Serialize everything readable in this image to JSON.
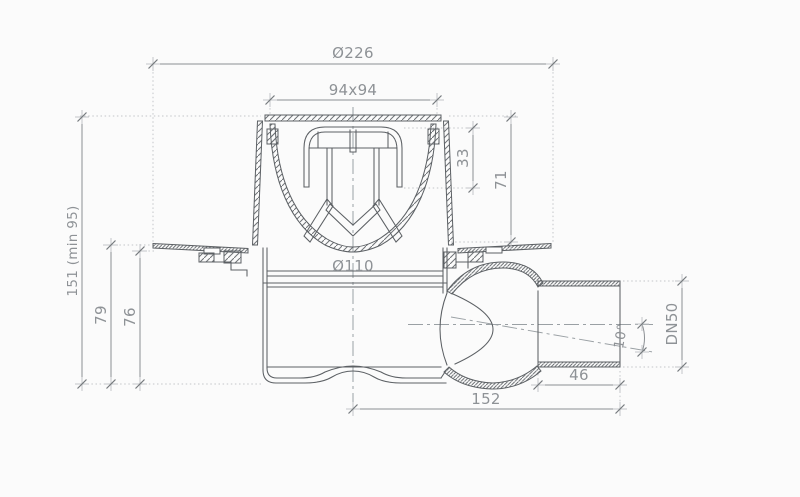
{
  "drawing": {
    "description": "Floor drain cross-section technical drawing with vertical body and swivelling side outlet",
    "dimensions": {
      "flange_diameter": "Ø226",
      "grate_size": "94x94",
      "insert_height": "33",
      "upper_depth": "71",
      "install_height": "151 (min 95)",
      "body_height": "79",
      "sump_height": "76",
      "body_diameter": "Ø110",
      "outlet_size": "DN50",
      "swivel_angle": "10°",
      "stub_length": "46",
      "outlet_reach": "152"
    },
    "colors": {
      "line": "#5c6064",
      "dim_line": "#8b8f93",
      "dim_text": "#8e9296",
      "extension": "#c3c6c9",
      "centerline": "#9aa0a4",
      "hatch": "#6f7377",
      "background": "#fbfbfb"
    }
  }
}
